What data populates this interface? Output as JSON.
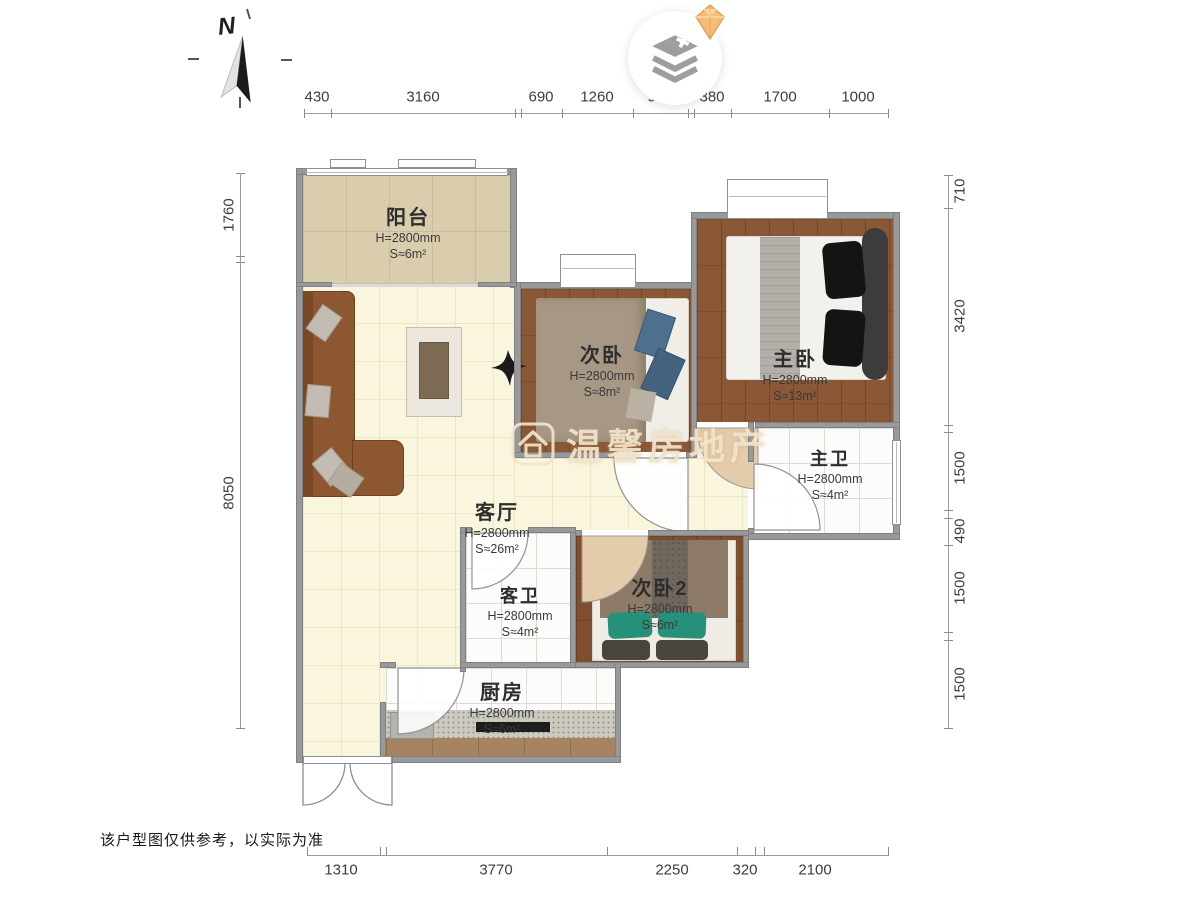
{
  "page": {
    "disclaimer": "该户型图仅供参考，以实际为准"
  },
  "compass": {
    "label": "N"
  },
  "watermark": {
    "brand": "温馨房地产"
  },
  "rooms": {
    "balcony": {
      "name": "阳台",
      "height": "H=2800mm",
      "area": "S≈6m²"
    },
    "bedroom2": {
      "name": "次卧",
      "height": "H=2800mm",
      "area": "S≈8m²"
    },
    "master": {
      "name": "主卧",
      "height": "H=2800mm",
      "area": "S≈13m²"
    },
    "master_bath": {
      "name": "主卫",
      "height": "H=2800mm",
      "area": "S≈4m²"
    },
    "living": {
      "name": "客厅",
      "height": "H=2800mm",
      "area": "S≈26m²"
    },
    "guest_bath": {
      "name": "客卫",
      "height": "H=2800mm",
      "area": "S≈4m²"
    },
    "bedroom3": {
      "name": "次卧2",
      "height": "H=2800mm",
      "area": "S≈6m²"
    },
    "kitchen": {
      "name": "厨房",
      "height": "H=2800mm",
      "area": "S≈6m²"
    }
  },
  "dimensions": {
    "top": [
      "430",
      "3160",
      "690",
      "1260",
      "950",
      "380",
      "1700",
      "1000"
    ],
    "left": [
      "1760",
      "8050"
    ],
    "right": [
      "710",
      "3420",
      "1500",
      "490",
      "1500",
      "1500"
    ],
    "bottom": [
      "1310",
      "3770",
      "2250",
      "320",
      "2100"
    ]
  },
  "colors": {
    "wall": "#98999b",
    "wood": "#8a5836",
    "cream": "#faf5dd",
    "accent_gem": "#f5bc74"
  }
}
